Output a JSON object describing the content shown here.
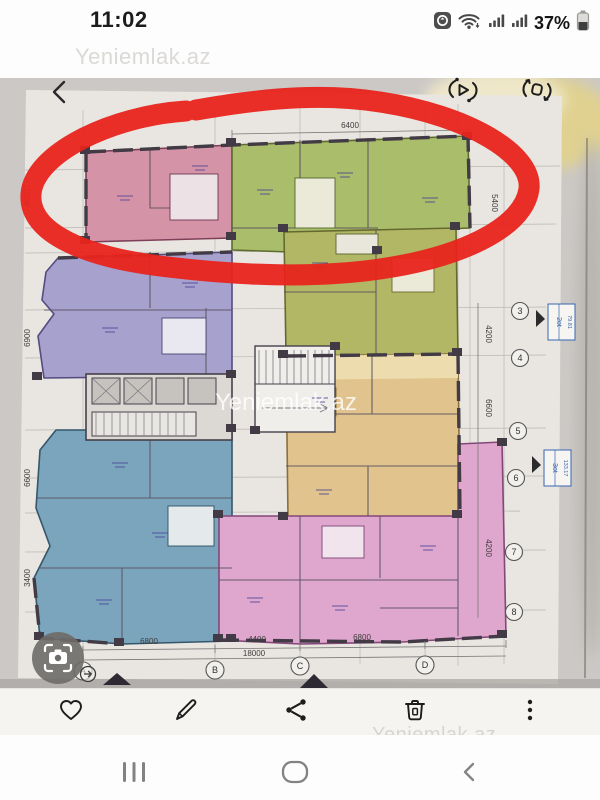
{
  "status_bar": {
    "time": "11:02",
    "battery": "37%"
  },
  "brand": {
    "watermark": "Yeniemlak.az"
  },
  "image_viewer": {
    "back_label": "back",
    "top_actions": [
      {
        "name": "motion-photo"
      },
      {
        "name": "rotate"
      }
    ]
  },
  "floor_plan": {
    "axis_letters": [
      "A",
      "B",
      "C",
      "D"
    ],
    "axis_numbers": [
      "3",
      "4",
      "5",
      "6",
      "7",
      "8"
    ],
    "dim_top": "6400",
    "dim_right_top": "5400",
    "dims_bottom": [
      "6800",
      "4400",
      "6800"
    ],
    "dim_bottom_total": "18000",
    "dims_left": [
      "4600",
      "6900",
      "6600",
      "3400"
    ],
    "dims_right": [
      "4200",
      "6600",
      "4200"
    ],
    "stamps": [
      {
        "title": "2ot",
        "area": "79.81"
      },
      {
        "title": "3ot",
        "area": "133.17"
      }
    ],
    "colors": {
      "unit_pink": "#d593a7",
      "unit_green": "#a9bd6a",
      "unit_purple": "#a7a1cd",
      "unit_olive": "#b2b765",
      "unit_blue": "#7aa5bc",
      "unit_tan": "#e1c38d",
      "unit_magenta": "#dfa7cd",
      "annotation_red": "#e8241c"
    }
  },
  "toolbar": {
    "items": [
      {
        "name": "favorite"
      },
      {
        "name": "edit"
      },
      {
        "name": "share"
      },
      {
        "name": "delete"
      },
      {
        "name": "more"
      }
    ]
  },
  "nav_bar": {
    "items": [
      {
        "name": "recents"
      },
      {
        "name": "home"
      },
      {
        "name": "back"
      }
    ]
  }
}
